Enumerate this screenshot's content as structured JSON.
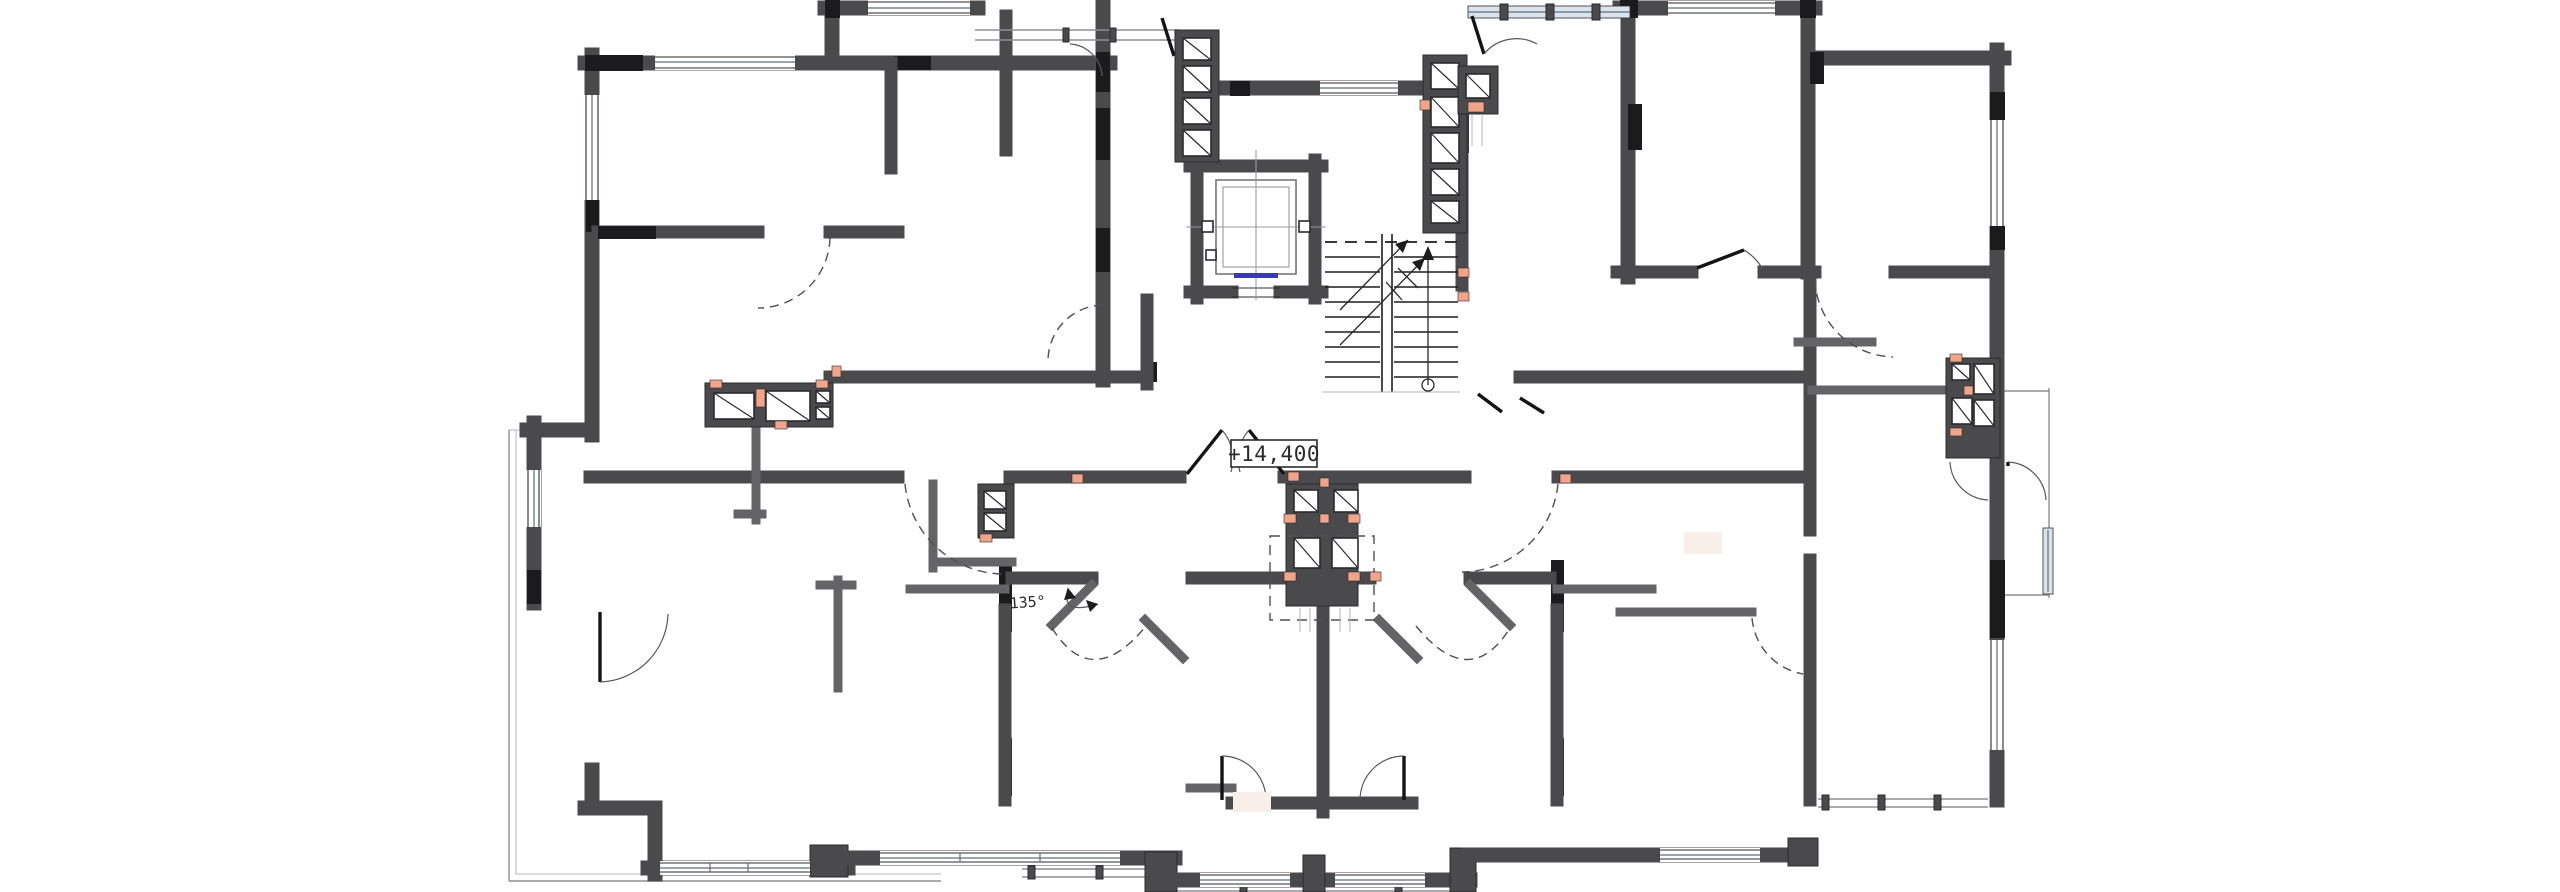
{
  "app": {
    "type": "architectural-floor-plan",
    "view": "residential floor plan with elevator core and stairwell"
  },
  "labels": {
    "floor_elevation": "+14,400",
    "wall_angle": "135°"
  },
  "colors": {
    "wall": "#4a4a4c",
    "wall2": "#646467",
    "lintel": "#1b1b1e",
    "line": "#2b2b2d",
    "orange": "#f2a489",
    "glass": "#dbe4ec",
    "glassline": "#5c6d7e",
    "thin": "#8f8f92",
    "paper": "#ffffff",
    "cream": "#f8f0e8",
    "blue": "#3b3bb0"
  },
  "elements": {
    "core": [
      "elevator-shaft",
      "elevator-car",
      "stairwell",
      "vent-shaft-left",
      "vent-shaft-right"
    ],
    "circulation": [
      "corridor",
      "lobby"
    ],
    "apartments": [
      "left-wing",
      "top-left-rooms",
      "top-right-rooms",
      "right-wing",
      "bottom-center-units"
    ],
    "exterior": [
      "balcony-left",
      "balcony-right",
      "balcony-bottom",
      "windows"
    ]
  }
}
